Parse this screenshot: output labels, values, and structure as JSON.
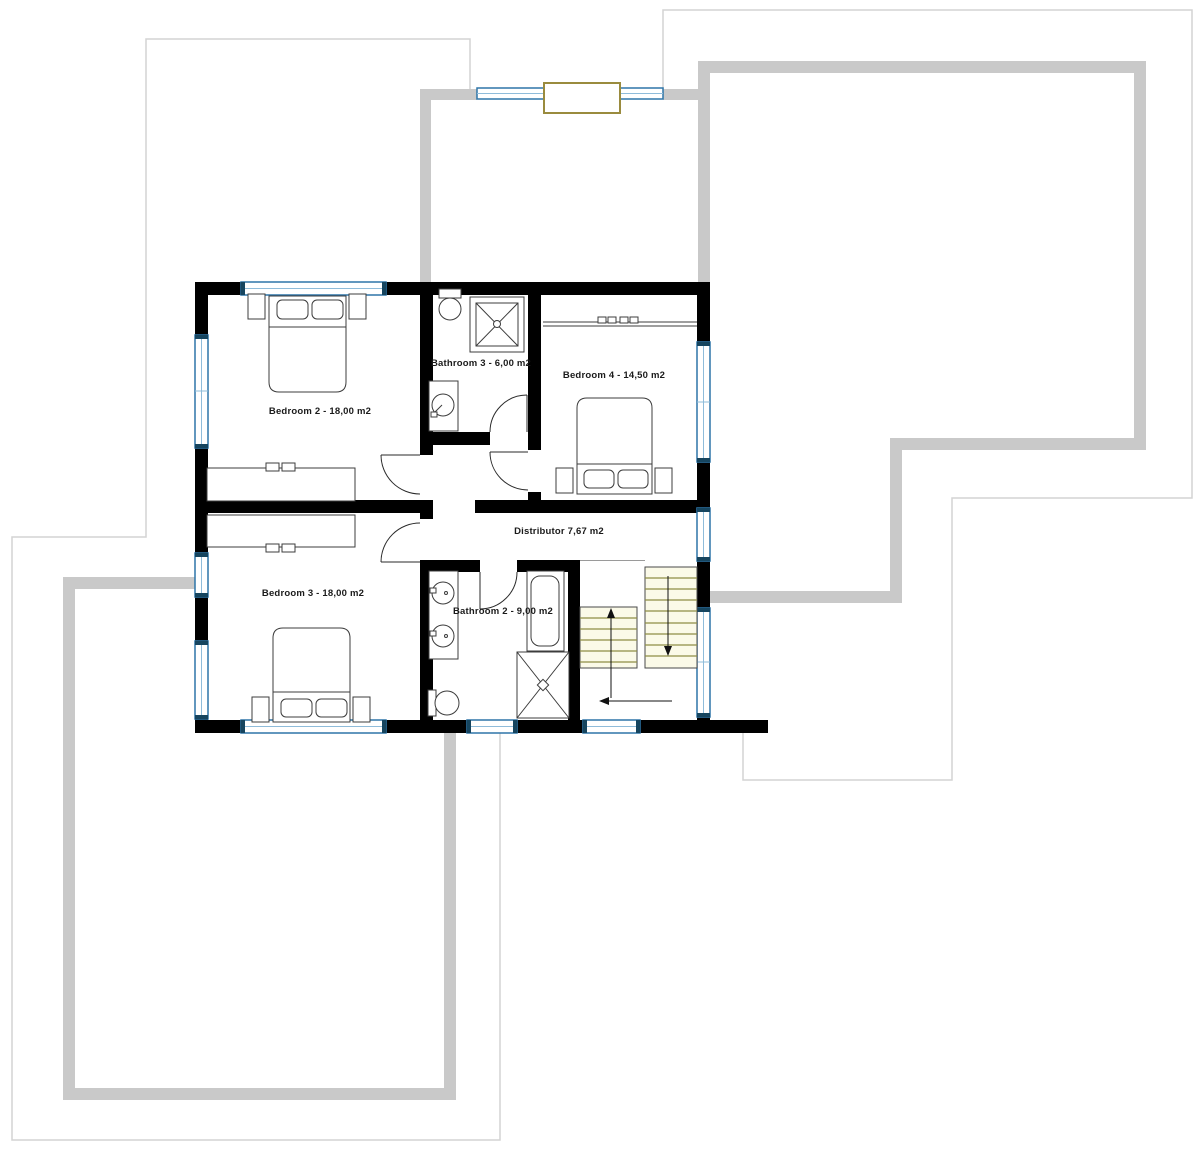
{
  "floor_plan": {
    "rooms": [
      {
        "id": "bedroom-2",
        "label": "Bedroom 2 - 18,00 m2"
      },
      {
        "id": "bathroom-3",
        "label": "Bathroom 3 - 6,00 m2"
      },
      {
        "id": "bedroom-4",
        "label": "Bedroom 4 - 14,50 m2"
      },
      {
        "id": "distributor",
        "label": "Distributor 7,67 m2"
      },
      {
        "id": "bedroom-3",
        "label": "Bedroom 3 - 18,00 m2"
      },
      {
        "id": "bathroom-2",
        "label": "Bathroom 2 - 9,00 m2"
      }
    ],
    "colors": {
      "wall": "#000000",
      "terrace_wall": "#c9c9c9",
      "roof_outline": "#d4d4d4",
      "window_frame": "#2e75a8",
      "window_cap": "#16455f",
      "stair_line": "#8e8e44",
      "stair_fill": "#fbfae8",
      "skylight_frame": "#9a8b3e",
      "furniture_line": "#3c3c3c",
      "background": "#ffffff"
    }
  }
}
